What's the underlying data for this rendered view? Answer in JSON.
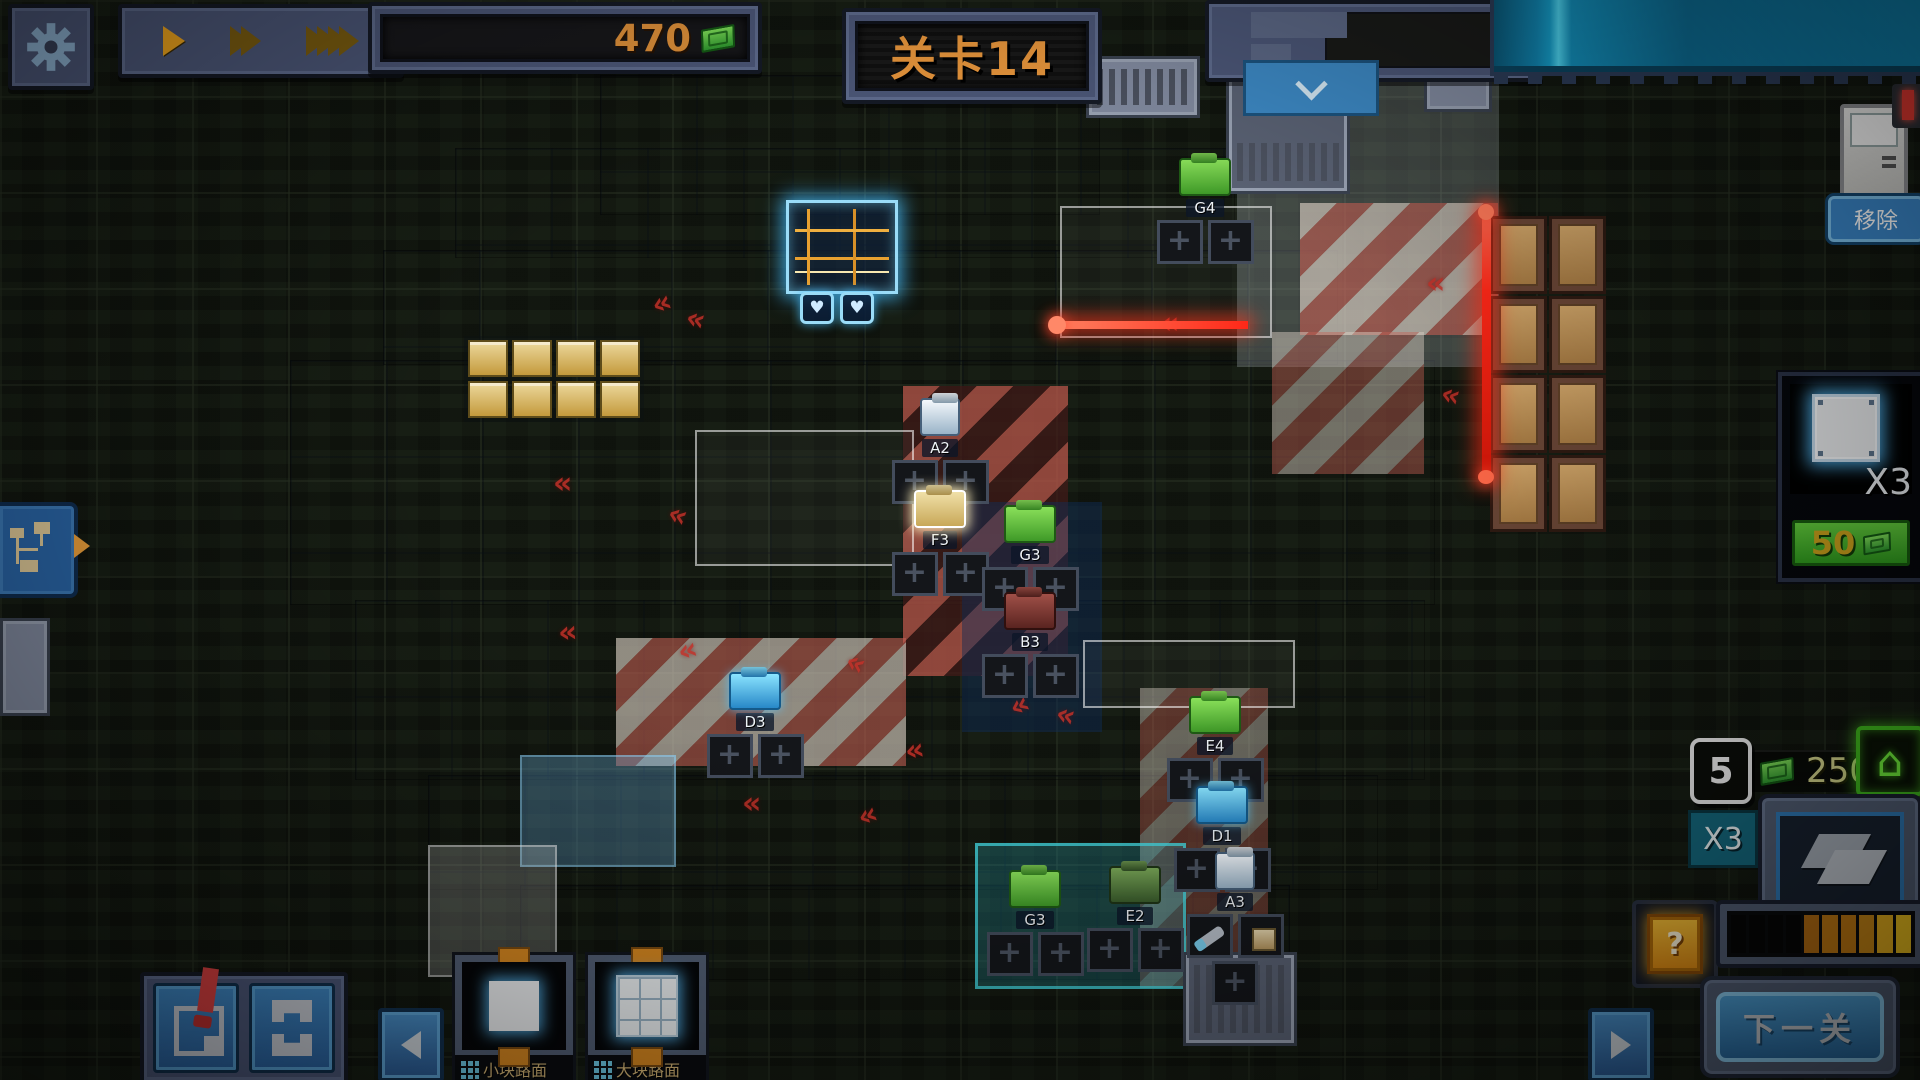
{
  "hud": {
    "money": "470",
    "level_title": "关卡14",
    "remove_label": "移除",
    "item_card": {
      "count_label": "X3",
      "price": "50"
    },
    "wave": {
      "number": "5",
      "reward": "250"
    },
    "multiplier": "X3",
    "chip_symbol": "?",
    "next_level": "下一关",
    "tiles": [
      {
        "label": "小块路面",
        "type": "small"
      },
      {
        "label": "大块路面",
        "type": "large"
      }
    ],
    "progress": {
      "total": 10,
      "filled": 6,
      "colors": [
        "",
        "",
        "",
        "",
        "#b86f12",
        "#c67c12",
        "#c67c12",
        "#cd8a16",
        "#ecb41e",
        "#f3c51f"
      ]
    }
  },
  "board": {
    "core": {
      "hearts": 2,
      "heart_glyph": "♥"
    },
    "chevron_glyph": "«",
    "units": [
      {
        "label": "G4",
        "x": 1150,
        "y": 158,
        "color": "green"
      },
      {
        "label": "A2",
        "x": 885,
        "y": 398,
        "color": "white"
      },
      {
        "label": "F3",
        "x": 885,
        "y": 490,
        "color": "gold"
      },
      {
        "label": "G3",
        "x": 975,
        "y": 505,
        "color": "green"
      },
      {
        "label": "B3",
        "x": 975,
        "y": 592,
        "color": "red"
      },
      {
        "label": "D3",
        "x": 700,
        "y": 672,
        "color": "cyan"
      },
      {
        "label": "E4",
        "x": 1160,
        "y": 696,
        "color": "green"
      },
      {
        "label": "D1",
        "x": 1167,
        "y": 786,
        "color": "cyan"
      },
      {
        "label": "G3",
        "x": 980,
        "y": 870,
        "color": "green"
      },
      {
        "label": "E2",
        "x": 1080,
        "y": 866,
        "color": "dgreen"
      },
      {
        "label": "A3",
        "x": 1180,
        "y": 852,
        "color": "white",
        "items": [
          "cannon",
          "device"
        ],
        "extra_slot": true
      }
    ],
    "chevrons": [
      {
        "x": 652,
        "y": 286,
        "r": -20
      },
      {
        "x": 686,
        "y": 302,
        "r": 15
      },
      {
        "x": 553,
        "y": 466,
        "r": 0
      },
      {
        "x": 668,
        "y": 498,
        "r": 20
      },
      {
        "x": 558,
        "y": 615,
        "r": -5
      },
      {
        "x": 678,
        "y": 633,
        "r": -15
      },
      {
        "x": 846,
        "y": 646,
        "r": 25
      },
      {
        "x": 742,
        "y": 786,
        "r": 0
      },
      {
        "x": 858,
        "y": 798,
        "r": -20
      },
      {
        "x": 1056,
        "y": 698,
        "r": 15
      },
      {
        "x": 1160,
        "y": 306,
        "r": 0
      },
      {
        "x": 1426,
        "y": 266,
        "r": 0
      },
      {
        "x": 1441,
        "y": 378,
        "r": 15
      },
      {
        "x": 1218,
        "y": 756,
        "r": 0
      },
      {
        "x": 905,
        "y": 733,
        "r": -10
      },
      {
        "x": 1010,
        "y": 688,
        "r": -25
      }
    ]
  },
  "decor": {
    "crate_count": 8,
    "capacitor_count": 8
  },
  "theme": {
    "accent_orange": "#e8963c",
    "money_green": "#3fae3f",
    "panel_blue": "#4c5778",
    "button_blue": "#3a86c8",
    "laser_red": "#ff2818",
    "stripe_blue": "#5ca0d0",
    "price_green": "#3daa28",
    "gold_text": "#caa11c"
  }
}
